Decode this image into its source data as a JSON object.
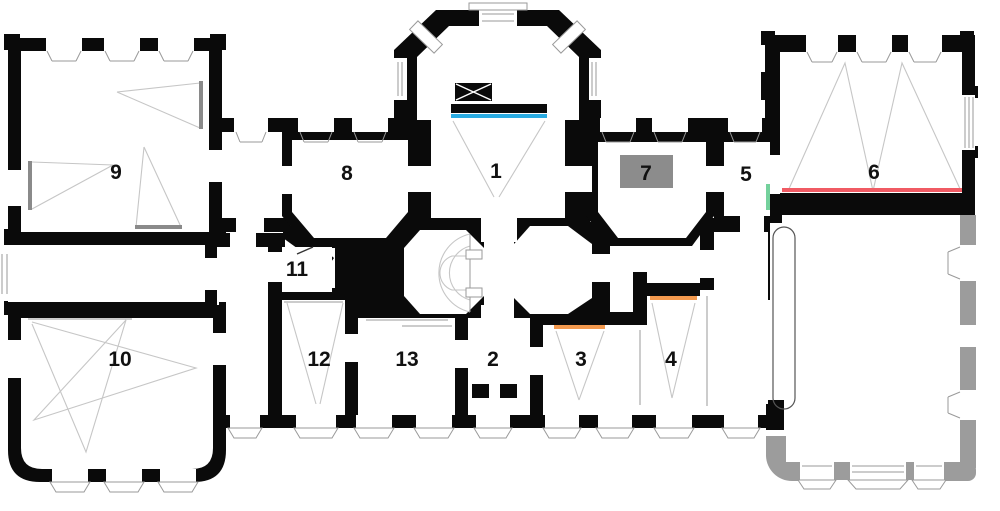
{
  "plan": {
    "rooms": [
      {
        "number": "1"
      },
      {
        "number": "2"
      },
      {
        "number": "3"
      },
      {
        "number": "4"
      },
      {
        "number": "5"
      },
      {
        "number": "6"
      },
      {
        "number": "7"
      },
      {
        "number": "8"
      },
      {
        "number": "9"
      },
      {
        "number": "10"
      },
      {
        "number": "11"
      },
      {
        "number": "12"
      },
      {
        "number": "13"
      }
    ]
  },
  "colors": {
    "wall": "#0a0a0a",
    "background": "#ffffff",
    "unbuilt": "#9c9c9c",
    "guide": "#c6c6c6",
    "furniture": "#8a8a8a",
    "room7_box": "#8c8c8c",
    "accent_cyan": "#29abe2",
    "accent_red": "#f05a63",
    "accent_orange": "#f3994e",
    "accent_green": "#74d19c",
    "label": "#111111"
  }
}
